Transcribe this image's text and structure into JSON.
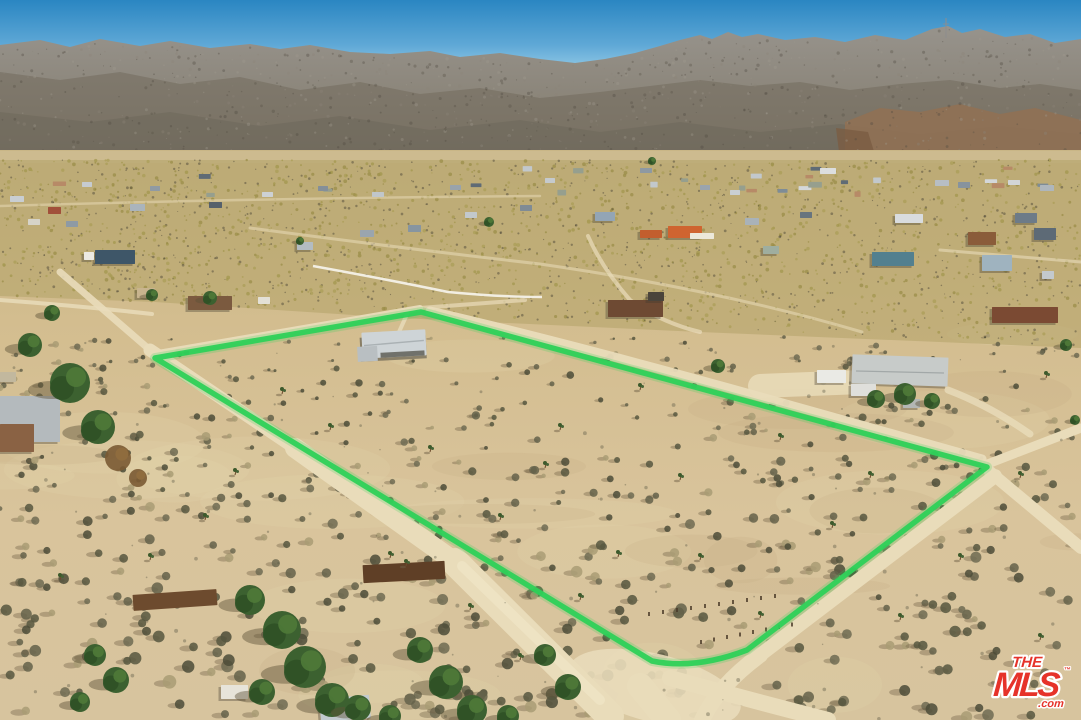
{
  "photo": {
    "kind": "aerial-drone-photo",
    "subject": "desert-parcel-with-boundary-overlay"
  },
  "property_boundary": {
    "color": "#2ed158",
    "glow_color": "#2ed158",
    "points": [
      [
        155,
        358
      ],
      [
        421,
        312
      ],
      [
        987,
        467
      ],
      [
        747,
        650
      ],
      [
        652,
        661
      ]
    ]
  },
  "watermark": {
    "line1": "THE",
    "line2": "MLS",
    "suffix": ".com",
    "trademark": "™",
    "red": "#e6332a",
    "outline": "#ffffff"
  },
  "palette": {
    "sky_top": "#2a86c2",
    "sky_mid": "#5fa8d6",
    "sky_horizon": "#9ccfe9",
    "mountain_top": "#97938c",
    "mountain_base": "#7f7767",
    "mountain_ridge_shade": "#6f6759",
    "mountain_brown": "#8f7155",
    "valley_strip": "#cdbb90",
    "olive_scrub": "#b3a268",
    "sand_far": "#c9b686",
    "sand_near": "#d9c49e",
    "road": "#e9dcba",
    "white_wall": "#f4f1e8",
    "tree_green": "#3c6130",
    "shrub_dark": "#57573f",
    "shadow": "#6f5f45"
  }
}
